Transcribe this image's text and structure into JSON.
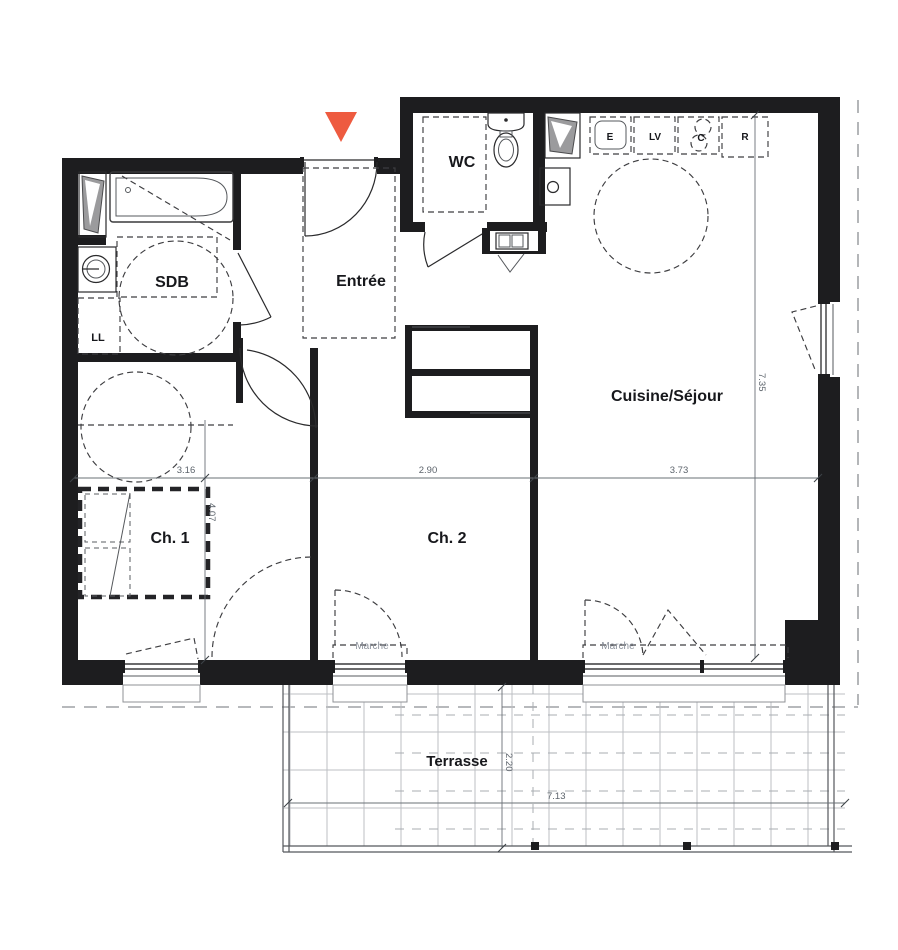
{
  "plan": {
    "title": "floor-plan",
    "rooms": {
      "wc": "WC",
      "sdb": "SDB",
      "entree": "Entrée",
      "cuisine": "Cuisine/Séjour",
      "ch1": "Ch. 1",
      "ch2": "Ch. 2",
      "terrasse": "Terrasse",
      "ll": "LL"
    },
    "appliances": {
      "e": "E",
      "lv": "LV",
      "c": "C",
      "r": "R"
    },
    "steps": {
      "marche1": "Marche",
      "marche2": "Marche"
    },
    "dimensions": {
      "ch1_width": "3.16",
      "ch2_width": "2.90",
      "cuisine_width": "3.73",
      "ch1_depth": "4.07",
      "cuisine_depth": "7.35",
      "terrasse_depth": "2.20",
      "terrasse_width": "7.13"
    },
    "colors": {
      "wall": "#1d1d1f",
      "accent": "#ee5b40",
      "dim_text": "#5d646c",
      "muted_text": "#8b919b",
      "grid": "#bcbfc3"
    }
  }
}
